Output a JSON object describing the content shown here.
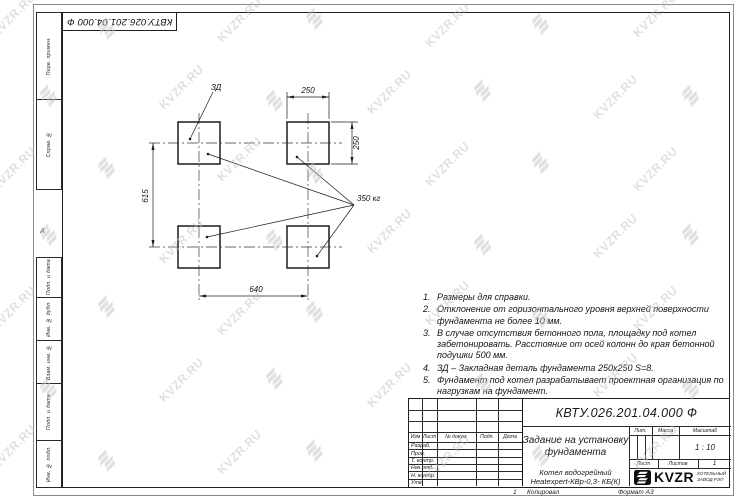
{
  "watermark": {
    "text": "KVZR.RU"
  },
  "margins": {
    "top_doc_number": "КВТУ.026.201.04.000 Ф",
    "zone_letter": "А",
    "sheet_tick": "1",
    "copied_label": "Копировал",
    "format_label": "Формат А3",
    "side_top_cells": [
      "Перв. примен.",
      "Справ. №"
    ],
    "side_bottom_cells": [
      "Подп. и дата",
      "Инв. № дубл.",
      "Взам. инв. №",
      "Подп. и дата",
      "Инв. № подл."
    ]
  },
  "drawing": {
    "embed_label": "ЗД",
    "load_label": "350 кг",
    "dim_top": "250",
    "dim_right": "250",
    "dim_left": "615",
    "dim_bottom": "640"
  },
  "notes": [
    {
      "num": "1.",
      "text": "Размеры для справки."
    },
    {
      "num": "2.",
      "text": "Отклонение от горизонтального уровня верхней поверхности фундамента не более 10 мм."
    },
    {
      "num": "3.",
      "text": "В случае отсутствия бетонного пола, площадку под котел забетонировать. Расстояние от осей колонн до края бетонной подушки 500 мм."
    },
    {
      "num": "4.",
      "text": "ЗД – Закладная деталь фундамента 250х250 S=8."
    },
    {
      "num": "5.",
      "text": "Фундамент под котел разрабатывает проектная организация по нагрузкам на фундамент."
    }
  ],
  "title_block": {
    "doc_number": "КВТУ.026.201.04.000 Ф",
    "title_line1": "Задание на установку",
    "title_line2": "фундамента",
    "product_line1": "Котел водогрейный",
    "product_line2": "Heatexpert-КВр-0,3- КБ(К)",
    "col_izm": "Изм",
    "col_list": "Лист",
    "col_doc": "№ докум.",
    "col_podp": "Подп.",
    "col_data": "Дата",
    "rows": [
      "Разраб.",
      "Пров.",
      "Т. контр.",
      "Нач.отд.",
      "Н. контр.",
      "Утв."
    ],
    "lit_label": "Лит.",
    "mass_label": "Масса",
    "scale_label": "Масштаб",
    "scale_value": "1 : 10",
    "sheet_label": "Лист",
    "sheets_label": "Листов",
    "sheets_value": "1",
    "logo_text": "KVZR",
    "logo_sub1": "КОТЕЛЬНЫЙ",
    "logo_sub2": "ЗАВОД РЭП"
  }
}
